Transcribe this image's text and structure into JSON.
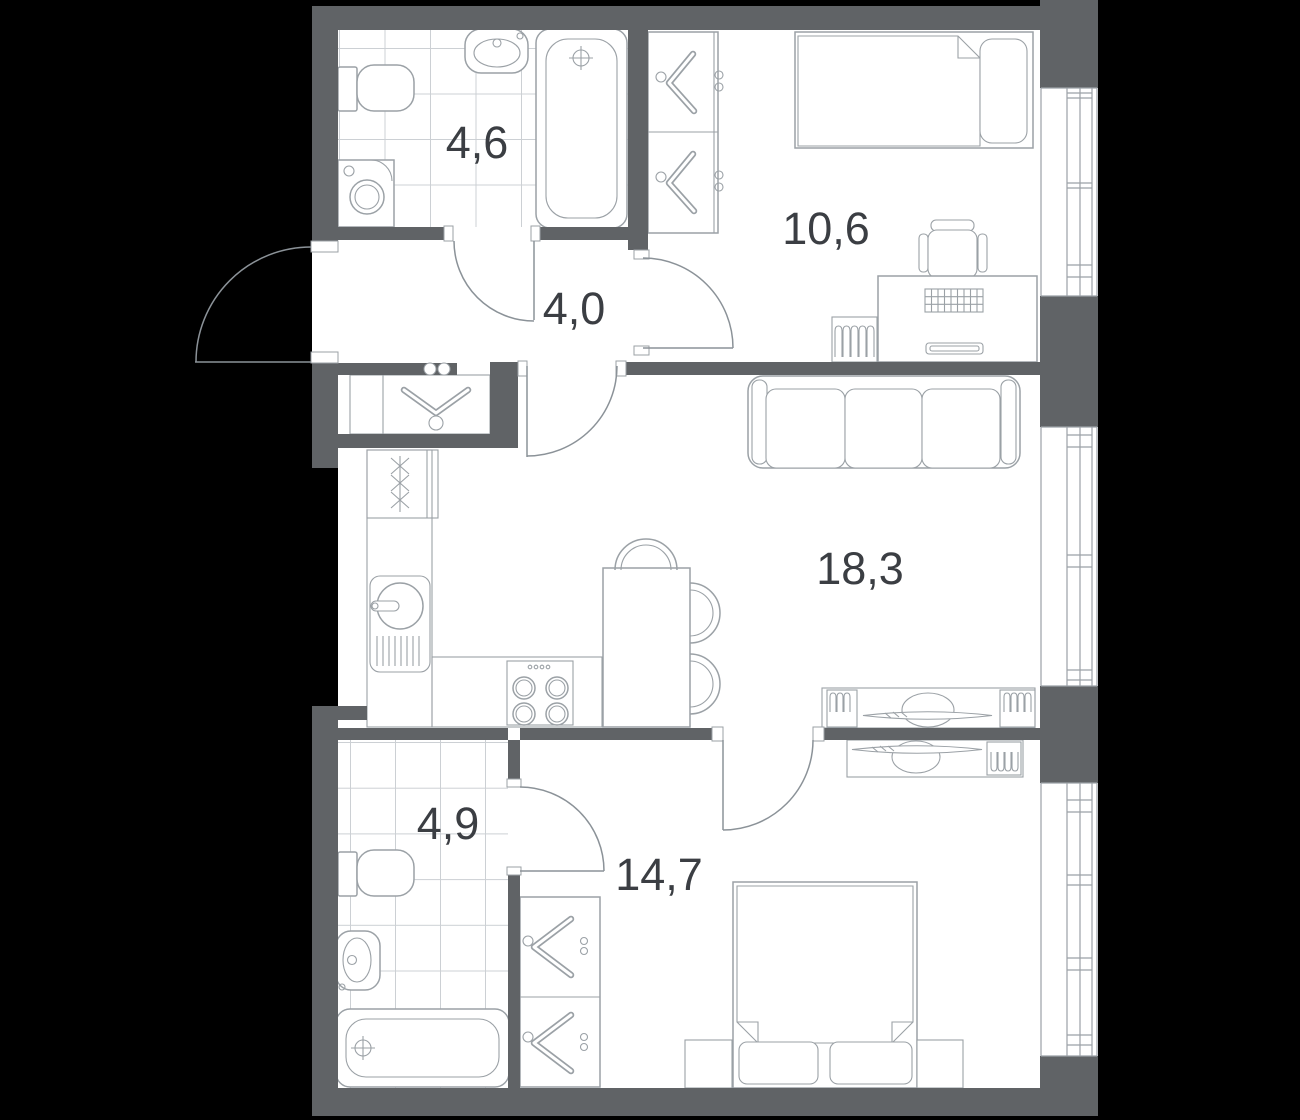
{
  "colors": {
    "background": "#000000",
    "wall": "#606366",
    "floor": "#ffffff",
    "fixture-line": "#9ba1a6",
    "door-line": "#8b9298",
    "tile-line": "#ccd0d4",
    "label-text": "#3b3e43"
  },
  "rooms": [
    {
      "id": "bathroom-top",
      "area_label": "4,6",
      "fixtures": [
        "toilet",
        "washbasin",
        "bathtub",
        "washing-machine",
        "tiled-floor",
        "door"
      ]
    },
    {
      "id": "bedroom-top",
      "area_label": "10,6",
      "fixtures": [
        "wardrobe",
        "single-bed",
        "desk",
        "desk-chair",
        "radiator",
        "window",
        "door"
      ]
    },
    {
      "id": "hallway",
      "area_label": "4,0",
      "fixtures": [
        "entrance-door",
        "coat-closet",
        "coat-hanger",
        "wall-hooks"
      ]
    },
    {
      "id": "kitchen-living-room",
      "area_label": "18,3",
      "fixtures": [
        "refrigerator",
        "kitchen-sink",
        "stove",
        "dining-table",
        "chairs",
        "sofa",
        "tv-stand",
        "window",
        "door"
      ]
    },
    {
      "id": "bathroom-bottom",
      "area_label": "4,9",
      "fixtures": [
        "toilet",
        "washbasin",
        "bathtub",
        "tiled-floor",
        "door"
      ]
    },
    {
      "id": "bedroom-bottom",
      "area_label": "14,7",
      "fixtures": [
        "wardrobe",
        "double-bed",
        "nightstands",
        "tv-stand",
        "window",
        "door"
      ]
    }
  ]
}
